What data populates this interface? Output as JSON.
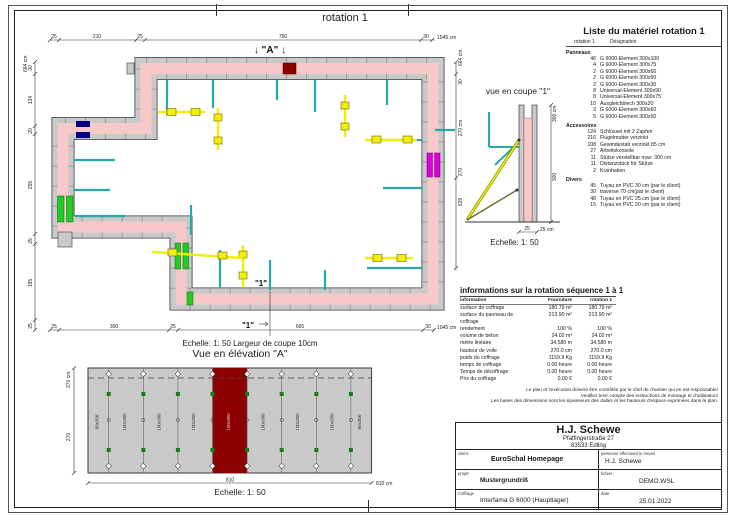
{
  "page": {
    "title": "rotation 1"
  },
  "plan": {
    "marker_a": "↓ \"A\" ↓",
    "marker_1a": "\"1\"",
    "marker_1b": "\"1\"",
    "caption": "Echelle: 1: 50   Largeur de coupe 10cm",
    "top_dims": [
      "25",
      "210",
      "25",
      "750",
      "30"
    ],
    "top_total": "1045 cm",
    "bottom_dims": [
      "25",
      "300",
      "25",
      "665",
      "30"
    ],
    "bottom_total": "1045 cm",
    "left_dims": [
      "30",
      "134",
      "20",
      "255",
      "25",
      "195",
      "25"
    ],
    "left_total": "684 cm",
    "right_total": "664 cm",
    "right_dims": [
      "30",
      "270 cm",
      "270",
      "629"
    ]
  },
  "section": {
    "title": "vue en coupe \"1\"",
    "caption": "Echelle: 1: 50",
    "dim_right_total": "300 cm",
    "dim_right_seg": "300",
    "dim_bottom_seg": "25",
    "dim_bottom_total": "25 cm"
  },
  "elevation": {
    "title": "Vue en élévation \"A\"",
    "caption": "Echelle: 1: 50",
    "panels": [
      "60x300",
      "100x300",
      "100x300",
      "100x300",
      "100x300",
      "100x300",
      "100x300",
      "100x300",
      "60x300"
    ],
    "dim_left_total": "270 cm",
    "dim_left_seg": "270",
    "dim_bottom_seg": "810",
    "dim_bottom_total": "810 cm"
  },
  "materials": {
    "title": "Liste du matériel  rotation 1",
    "header_col1": "rotation 1",
    "header_col2": "Désignation",
    "group1": "Panneaux",
    "group2": "Accessoires",
    "group3": "Divers",
    "panneaux": [
      {
        "qty": "46",
        "label": "G 6000-Element 300x100"
      },
      {
        "qty": "4",
        "label": "G 6000-Element 300x75"
      },
      {
        "qty": "2",
        "label": "G 6000-Element 300x60"
      },
      {
        "qty": "2",
        "label": "G 6000-Element 300x50"
      },
      {
        "qty": "2",
        "label": "G 6000-Element 300x30"
      },
      {
        "qty": "8",
        "label": "Universal-Element 300x90"
      },
      {
        "qty": "8",
        "label": "Universal-Element 300x75"
      },
      {
        "qty": "10",
        "label": "Ausgleichblech 300x20"
      },
      {
        "qty": "3",
        "label": "G 6000-Element 300x60"
      },
      {
        "qty": "5",
        "label": "G 6000-Element 300x50"
      }
    ],
    "accessoires": [
      {
        "qty": "124",
        "label": "Schlüssel mit 2 Zapfen"
      },
      {
        "qty": "216",
        "label": "Flügelmutter verzinkt"
      },
      {
        "qty": "108",
        "label": "Gewindestab verzinkt 85 cm"
      },
      {
        "qty": "27",
        "label": "Arbeitskonsole"
      },
      {
        "qty": "11",
        "label": "Stütze verstellbar max. 300 cm"
      },
      {
        "qty": "11",
        "label": "Distanzstück für Stütze"
      },
      {
        "qty": "2",
        "label": "Kranhaken"
      }
    ],
    "divers": [
      {
        "qty": "45",
        "label": "Tuyau en PVC 30 cm (par le client)"
      },
      {
        "qty": "30",
        "label": "traverse 70 cm(par le client)"
      },
      {
        "qty": "48",
        "label": "Tuyau en PVC 25 cm (par le client)"
      },
      {
        "qty": "15",
        "label": "Tuyau en PVC 20 cm (par le client)"
      }
    ]
  },
  "info": {
    "title": "informations sur la rotation  séquence 1 à 1",
    "columns": [
      "information",
      "Fourniture",
      "rotation 1"
    ],
    "rows": [
      {
        "label": "surface de coffrage",
        "v1": "180.79 m²",
        "v2": "180.79 m²"
      },
      {
        "label": "surface du panneau de coffrage",
        "v1": "213.90 m²",
        "v2": "213.90 m²"
      },
      {
        "label": "rendement",
        "v1": "100 %",
        "v2": "100 %"
      },
      {
        "label": "volume de béton",
        "v1": "24.02 m³",
        "v2": "24.02 m³"
      },
      {
        "label": "mètre linéaire",
        "v1": "34.580 m",
        "v2": "34.580 m"
      },
      {
        "label": "hauteur de voile",
        "v1": "270.0 cm",
        "v2": "270.0 cm"
      },
      {
        "label": "poids du coffrage",
        "v1": "1159.9 Kg",
        "v2": "1159.9 Kg"
      },
      {
        "label": "temps de coffrage",
        "v1": "0.00 heure",
        "v2": "0.00 heure"
      },
      {
        "label": "Temps de décoffrage",
        "v1": "0.00 heure",
        "v2": "0.00 heure"
      },
      {
        "label": "Prix du coffrage",
        "v1": "0.00 €",
        "v2": "0.00 €"
      }
    ]
  },
  "disclaimer": [
    "Le plan et l'exécution doivent être contrôlés par le chef de chantier qui en est responsable!",
    "Veuillez tenir compte des instructions de montage et d'utilisation!",
    "Les bases des dimensions sont les épaisseurs des dalles et les hauteurs d'espace exprimées dans le plan."
  ],
  "titleblock": {
    "company": "H.J. Schewe",
    "address1": "Pfaffingerstraße 27",
    "address2": "83533 Edling",
    "row1_label": "client:",
    "row1_value": "EuroSchal Homepage",
    "row1_rlabel": "personne effectuant le travail",
    "row1_rvalue": "H.J. Schewe",
    "row2_label": "projet:",
    "row2_value": "Mustergrundriß",
    "row2_rlabel": "fichier",
    "row2_rvalue": "DEMO.WSL",
    "row3_label": "Coffrage",
    "row3_value": "Interfama G 6000 (Hauptlager)",
    "row3_rlabel": "date",
    "row3_rvalue": "25.01.2022"
  },
  "colors": {
    "wall_pink": "#f6c8c8",
    "formwork_gray": "#c9c9c9",
    "highlight_red": "#8b0000",
    "green_element": "#22cc22",
    "yellow_prop": "#f2ee0a",
    "cyan_support": "#2aa7a7",
    "magenta_element": "#dd00dd",
    "navy_element": "#000080"
  }
}
